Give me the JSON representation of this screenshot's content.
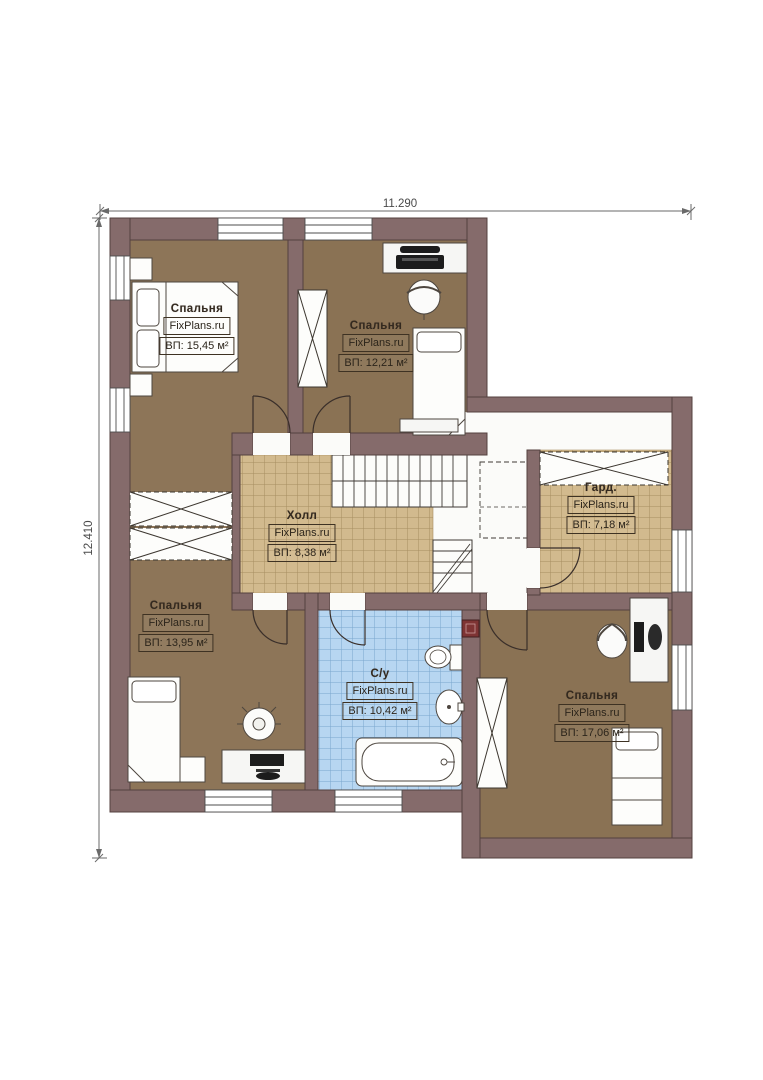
{
  "plan": {
    "title": "Floor plan (second storey)",
    "brand": "FixPlans.ru"
  },
  "dimensions": {
    "width_label": "11.290",
    "height_label": "12.410"
  },
  "rooms": [
    {
      "id": "bedroom-1",
      "name": "Спальня",
      "brand": "FixPlans.ru",
      "area": "ВП: 15,45 м²"
    },
    {
      "id": "bedroom-2",
      "name": "Спальня",
      "brand": "FixPlans.ru",
      "area": "ВП: 12,21 м²"
    },
    {
      "id": "hall",
      "name": "Холл",
      "brand": "FixPlans.ru",
      "area": "ВП: 8,38 м²"
    },
    {
      "id": "wardrobe",
      "name": "Гард.",
      "brand": "FixPlans.ru",
      "area": "ВП: 7,18 м²"
    },
    {
      "id": "bedroom-3",
      "name": "Спальня",
      "brand": "FixPlans.ru",
      "area": "ВП: 13,95 м²"
    },
    {
      "id": "bathroom",
      "name": "С/у",
      "brand": "FixPlans.ru",
      "area": "ВП: 10,42 м²"
    },
    {
      "id": "bedroom-4",
      "name": "Спальня",
      "brand": "FixPlans.ru",
      "area": "ВП: 17,06 м²"
    }
  ],
  "colors": {
    "wall": "#856b6b",
    "wall_edge": "#54403f",
    "bedroom_floor": "#8d7558",
    "hall_tile": "#d2ba8e",
    "bath_tile": "#b7d6f1",
    "vent": "#7e3434",
    "dimension_line": "#6a6a6a"
  }
}
